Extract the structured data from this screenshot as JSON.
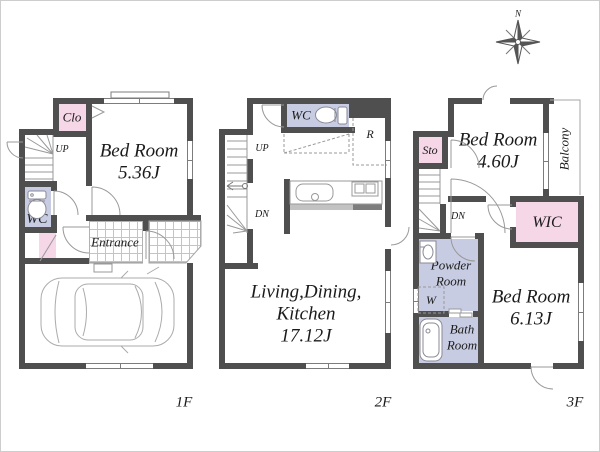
{
  "colors": {
    "wall": "#4f4f4f",
    "room_pink": "#f5d7e7",
    "room_lavender": "#c8cce2",
    "tile_line": "#c4c4c4",
    "text": "#1b1b1b",
    "linework": "#999999"
  },
  "compass": {
    "north": "N"
  },
  "floor1": {
    "label": "1F",
    "closet": "Clo",
    "up": "UP",
    "wc": "WC",
    "bedroom_name": "Bed Room",
    "bedroom_area": "5.36J",
    "entrance": "Entrance"
  },
  "floor2": {
    "label": "2F",
    "wc": "WC",
    "refrigerator": "R",
    "up": "UP",
    "down": "DN",
    "ldk_line1": "Living,Dining,",
    "ldk_line2": "Kitchen",
    "ldk_area": "17.12J"
  },
  "floor3": {
    "label": "3F",
    "storage": "Sto",
    "down": "DN",
    "bedroom1_name": "Bed Room",
    "bedroom1_area": "4.60J",
    "balcony": "Balcony",
    "wic": "WIC",
    "powder_line1": "Powder",
    "powder_line2": "Room",
    "washer": "W",
    "bath_line1": "Bath",
    "bath_line2": "Room",
    "bedroom2_name": "Bed Room",
    "bedroom2_area": "6.13J"
  }
}
